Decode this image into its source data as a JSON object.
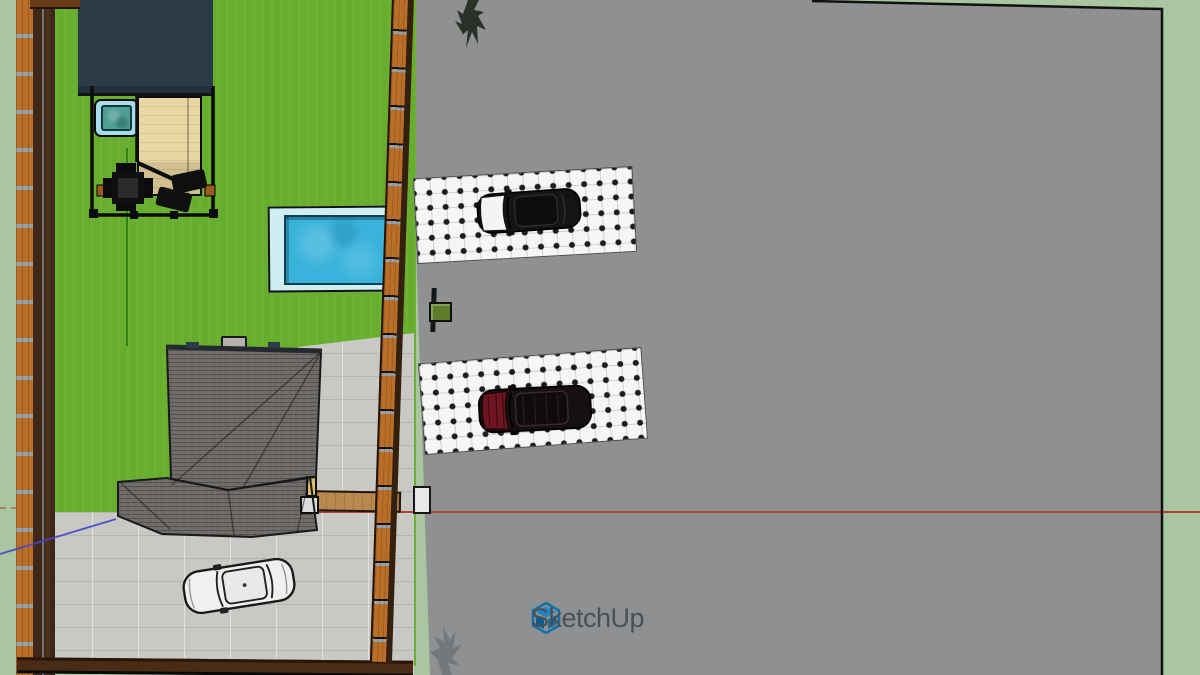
{
  "app": {
    "name": "SketchUp",
    "watermark": {
      "label": "SketchUp",
      "text_color": "#4a5056",
      "logo_color": "#1470a8"
    }
  },
  "viewport": {
    "width": 1200,
    "height": 675,
    "view": "top-down orthographic model view"
  },
  "colors": {
    "margin_sage": "#a9c6a0",
    "road_gray": "#8f9092",
    "grass_green": "#68ae2e",
    "driveway_gray": "#c8c8c4",
    "fence_orange": "#b96f28",
    "fence_dark_brown": "#3f2817",
    "roof_gray": "#6f6b68",
    "shed_navy": "#2c3b48",
    "deck_tan": "#e6d5a3",
    "pool_water_blue": "#39b3dc",
    "pool_deck_cyan": "#cfeef4",
    "hot_tub_teal": "#4f9e96",
    "parking_pad_white": "#f6f6f4",
    "car_black": "#141414",
    "car_dark_red": "#6e1520",
    "car_white": "#f0f0ee",
    "mailbox_green": "#5c7c2a",
    "axis_red": "#b04438",
    "axis_green": "#2e7d0f",
    "axis_blue": "#4646c8"
  },
  "axes": {
    "red_axis_y": 511,
    "green_axis_x": 126,
    "blue_axis_segment": {
      "from": [
        0,
        554
      ],
      "to": [
        116,
        519
      ]
    }
  },
  "scene_objects": [
    "shed-building",
    "hot-tub",
    "wood-deck",
    "patio-table-set",
    "sun-loungers",
    "swimming-pool",
    "hip-roof-house",
    "chimney",
    "driveway",
    "white-sedan",
    "left-fence",
    "right-fence",
    "bottom-fence",
    "gate-post",
    "mailbox",
    "parking-pad-north",
    "black-suv",
    "parking-pad-south",
    "dark-red-suv",
    "road",
    "tree-north",
    "shrub-south"
  ]
}
